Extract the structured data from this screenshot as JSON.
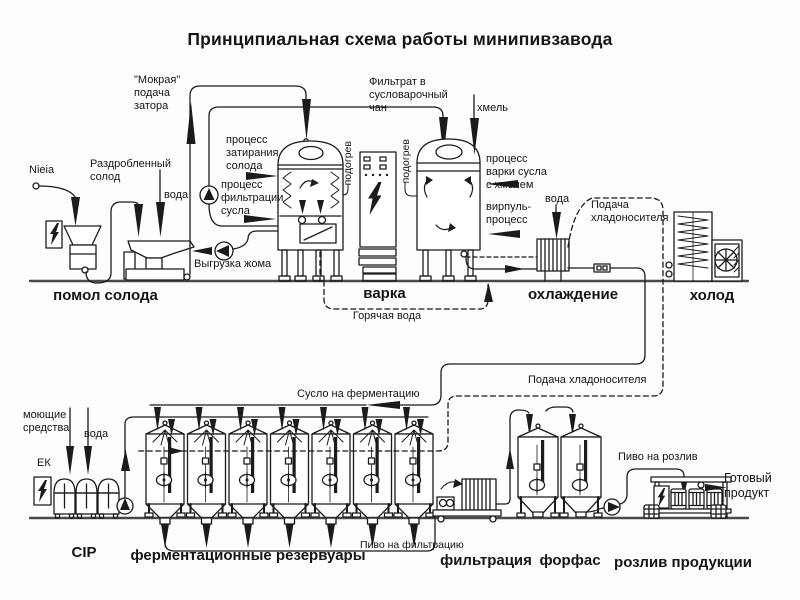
{
  "title": "Принципиальная схема работы минипивзавода",
  "sections": {
    "milling": "помол солода",
    "brewing": "варка",
    "cooling": "охлаждение",
    "cold": "холод",
    "cip": "CIP",
    "fermentation": "ферментационные резервуары",
    "filtration": "фильтрация",
    "forfas": "форфас",
    "bottling": "розлив продукции"
  },
  "annotations": {
    "malt_supply": "Nieia",
    "crushed_malt": "Раздробленный\nсолод",
    "water_mill": "вода",
    "wet_mash": "\"Мокрая\"\nподача\nзатора",
    "mashing_process": "процесс\nзатирания\nсолода",
    "wort_filtration_process": "процесс\nфильтрации\nсусла",
    "spent_grain_discharge": "Выгрузка жома",
    "heating_mash_tun": "подогрев",
    "heating_kettle": "подогрев",
    "filtrate_to_kettle": "Фильтрат в\nсусловарочный\nчан",
    "hops": "хмель",
    "boiling_process": "процесс\nварки сусла\nс хмелем",
    "whirlpool_process": "вирпуль-\nпроцесс",
    "hot_water": "Горячая вода",
    "water_cooling": "вода",
    "coolant_supply_top": "Подача\nхладоносителя",
    "coolant_supply_bottom": "Подача хладоносителя",
    "wort_to_fermentation": "Сусло на ферментацию",
    "detergents": "моющие\nсредства",
    "water_cip": "вода",
    "ek_unit": "ЕК",
    "beer_to_filtration": "Пиво на фильтрацию",
    "beer_to_bottling": "Пиво на розлив",
    "finished_product": "Готовый\nпродукт"
  },
  "colors": {
    "ink": "#1b1b1b",
    "paper": "#ffffff"
  }
}
